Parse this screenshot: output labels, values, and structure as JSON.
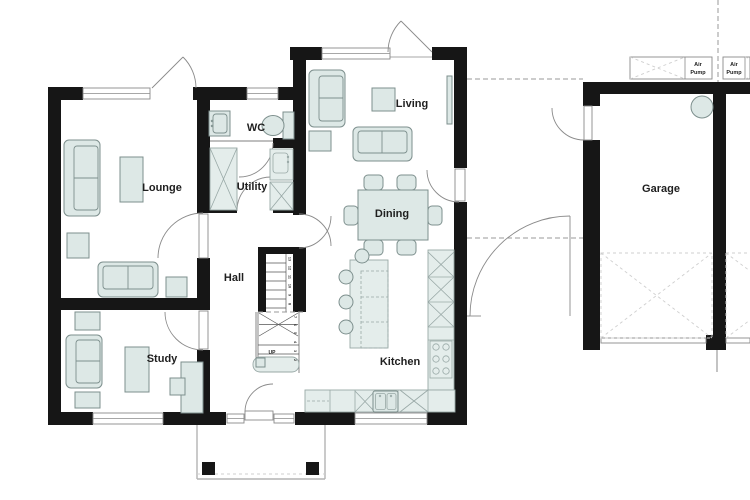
{
  "rooms": {
    "lounge": "Lounge",
    "study": "Study",
    "hall": "Hall",
    "wc": "WC",
    "utility": "Utility",
    "living": "Living",
    "dining": "Dining",
    "kitchen": "Kitchen",
    "garage": "Garage"
  },
  "stairs": {
    "direction_label": "UP",
    "step_numbers": [
      "13",
      "12",
      "11",
      "10",
      "9",
      "8",
      "7",
      "6",
      "5",
      "4",
      "3",
      "2"
    ]
  },
  "equipment": {
    "air_pump": {
      "line1": "Air",
      "line2": "Pump"
    }
  },
  "colors": {
    "wall": "#161616",
    "furniture_fill": "#dde8e6",
    "furniture_outline": "#7d8f8d",
    "counter_fill": "#e4edeb",
    "label_text": "#1f1f1f",
    "door_arc": "#8a8a8a",
    "site_dashed": "#9a9a9a"
  }
}
